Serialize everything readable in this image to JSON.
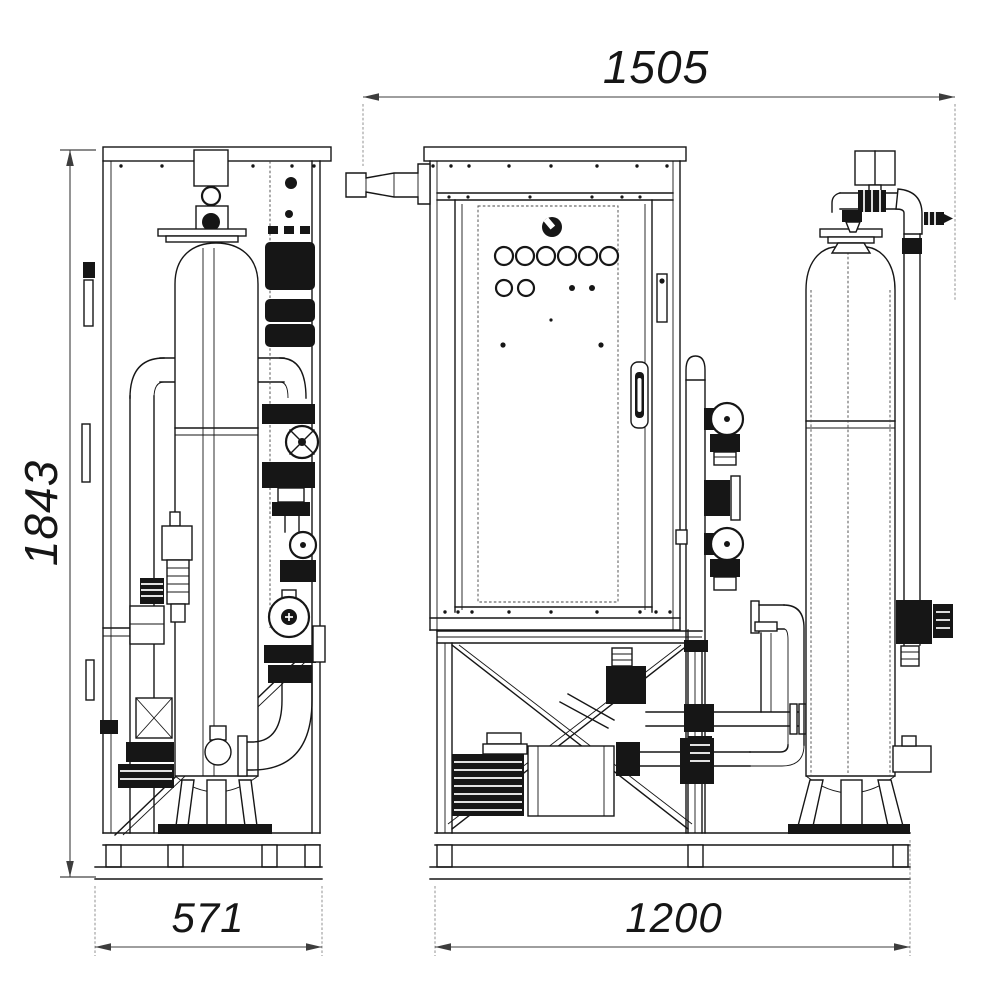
{
  "canvas": {
    "background": "#ffffff"
  },
  "drawing": {
    "line_color": "#161616",
    "dim_line_color": "#3d3d3d",
    "text_color": "#161616",
    "dimensions": {
      "overall_width": "1505",
      "overall_height": "1843",
      "side_depth": "571",
      "base_width": "1200"
    }
  }
}
